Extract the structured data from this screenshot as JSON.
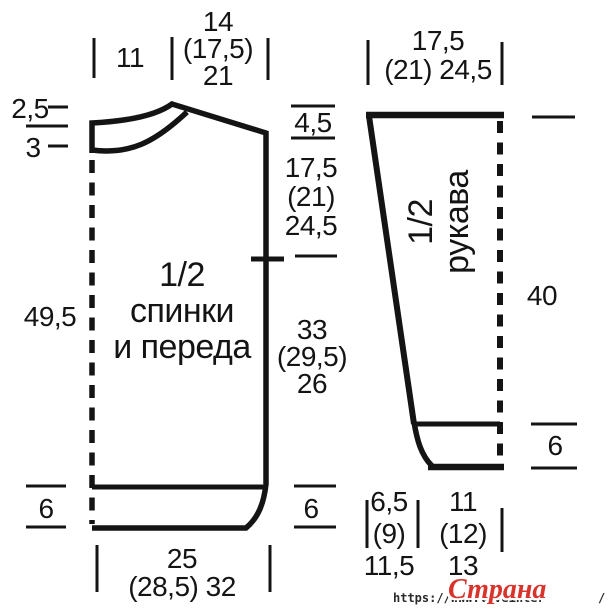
{
  "diagram": {
    "body": {
      "piece_label": [
        "1/2",
        "спинки",
        "и переда"
      ],
      "top_width": [
        "14",
        "(17,5)",
        "21"
      ],
      "shoulder_width": "11",
      "neck_back": "2,5",
      "neck_front": "3",
      "side_length": "49,5",
      "shoulder_slope": "4,5",
      "armhole": [
        "17,5",
        "(21)",
        "24,5"
      ],
      "lower": [
        "33",
        "(29,5)",
        "26"
      ],
      "rib_left": "6",
      "rib_right": "6",
      "bottom_width": [
        "25",
        "(28,5) 32"
      ]
    },
    "sleeve": {
      "piece_label": [
        "1/2",
        "рукава"
      ],
      "top_width": [
        "17,5",
        "(21) 24,5"
      ],
      "length": "40",
      "rib": "6",
      "cuff_a": [
        "6,5",
        "(9)",
        "11,5"
      ],
      "cuff_b": [
        "11",
        "(12)",
        "13"
      ]
    }
  },
  "watermark": {
    "url": "https://www.liveinter",
    "url_tail": "/",
    "site": "Страна Мам",
    "accent_color": "#d8342c"
  },
  "colors": {
    "line": "#141414",
    "background": "#ffffff"
  }
}
